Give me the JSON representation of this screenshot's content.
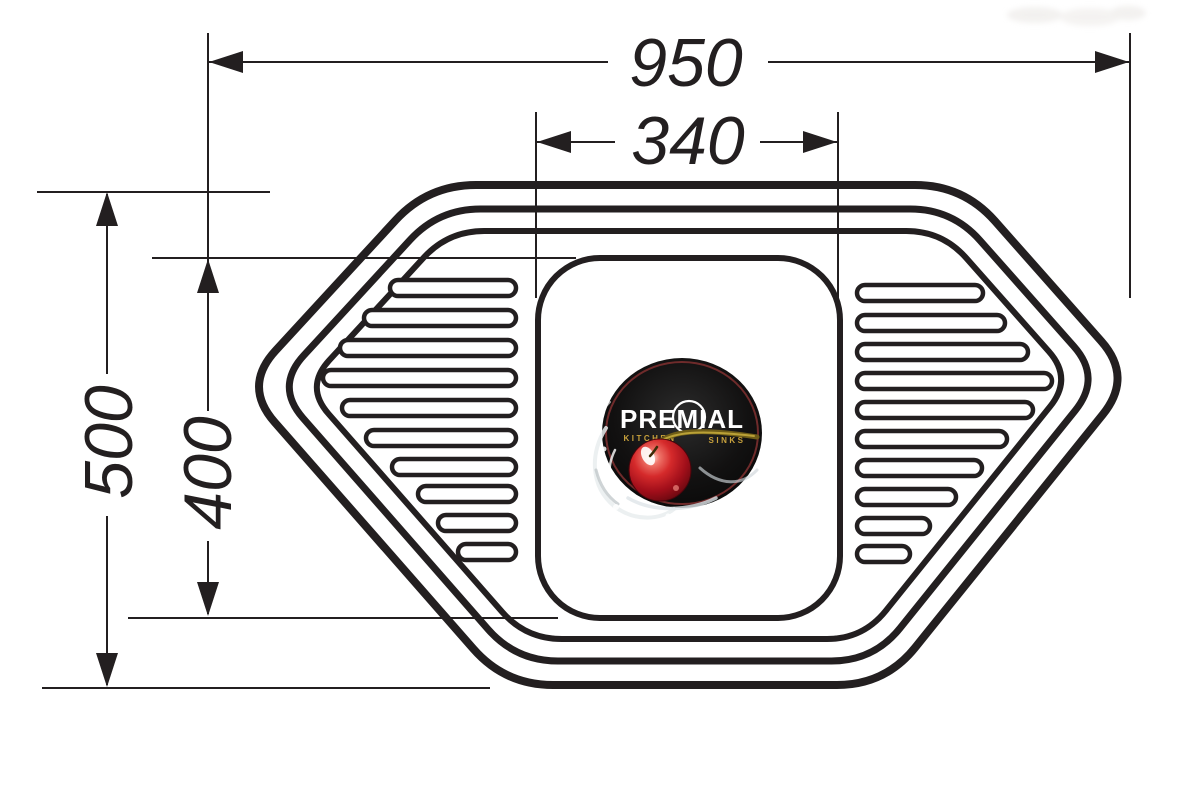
{
  "drawing": {
    "type": "technical dimension drawing",
    "subject": "trapezoidal corner kitchen sink, top view"
  },
  "dimensions": {
    "overall_width": "950",
    "bowl_width": "340",
    "overall_depth": "500",
    "bowl_depth": "400"
  },
  "logo": {
    "brand": "PREMIAL",
    "tagline_left": "KITCHEN",
    "tagline_right": "SINKS"
  },
  "colors": {
    "background": "#ffffff",
    "line": "#231f20",
    "logo_bg": "#0b0a0a",
    "logo_ring": "#6f2b2b",
    "brand_text": "#ffffff",
    "tagline_gold": "#c9a23c",
    "cherry_red": "#cc1520",
    "cherry_dark": "#5d060e",
    "stem_gold": "#a08a28",
    "splash": "#e9edef"
  }
}
